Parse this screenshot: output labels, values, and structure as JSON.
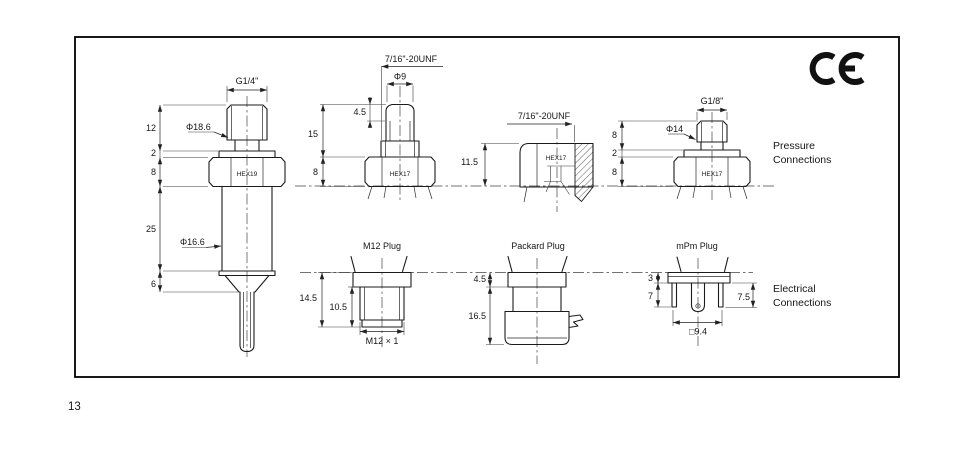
{
  "page_number": "13",
  "ce_mark": {
    "icon": "ce-certification-mark"
  },
  "section_labels": {
    "pressure_line1": "Pressure",
    "pressure_line2": "Connections",
    "electrical_line1": "Electrical",
    "electrical_line2": "Connections"
  },
  "pressure_drawings": {
    "g14": {
      "thread_label": "G1/4\"",
      "dia_upper": "Φ18.6",
      "dia_lower": "Φ16.6",
      "hex_label": "HEX19",
      "dim_thread": "12",
      "dim_washer": "2",
      "dim_hex": "8",
      "dim_body": "25",
      "dim_tip": "6"
    },
    "unf_front": {
      "thread_label": "7/16\"-20UNF",
      "tip_dia": "Φ9",
      "tip_height": "4.5",
      "dim_height": "15",
      "dim_hex": "8",
      "hex_label": "HEX17"
    },
    "unf_section": {
      "thread_label": "7/16\"-20UNF",
      "hex_label": "HEX17",
      "dim_height": "11.5"
    },
    "g18": {
      "thread_label": "G1/8\"",
      "thread_dia": "Φ14",
      "dim_thread": "8",
      "dim_washer": "2",
      "dim_hex": "8",
      "hex_label": "HEX17"
    }
  },
  "electrical_drawings": {
    "m12": {
      "title": "M12 Plug",
      "thread_label": "M12 × 1",
      "dim_total": "14.5",
      "dim_thread": "10.5"
    },
    "packard": {
      "title": "Packard Plug",
      "dim_flange": "4.5",
      "dim_body": "16.5"
    },
    "mpm": {
      "title": "mPm Plug",
      "dim_plate": "3",
      "dim_pins": "7",
      "dim_pins_right": "7.5",
      "dim_square": "□9.4"
    }
  }
}
